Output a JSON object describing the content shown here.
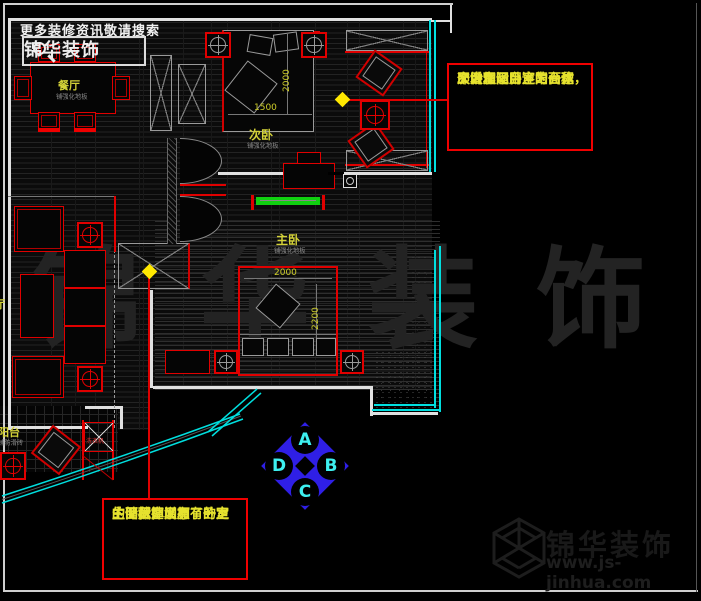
{
  "header": {
    "tagline": "更多装修资讯敬请搜索",
    "brand": "锦华装饰",
    "icon": "magnifier-icon"
  },
  "plan": {
    "rooms": [
      {
        "name": "餐厅",
        "floor_note": "铺强化地板"
      },
      {
        "name": "次卧",
        "floor_note": "铺强化地板"
      },
      {
        "name": "主卧",
        "floor_note": "铺强化地板"
      },
      {
        "name": "阳台",
        "floor_note": "铺防滑砖"
      },
      {
        "name": "厅",
        "floor_note": ""
      }
    ],
    "dimensions": {
      "second_bed_width": "1500",
      "second_bed_length": "2000",
      "master_bed_width": "2000",
      "master_bed_length": "2200"
    },
    "equipment_label": "洗衣机"
  },
  "annotations": [
    {
      "lines": [
        "次卧和阳台连为一体，",
        "即增加了卧室的面积",
        "又合理运用了阳台这",
        "个大空间"
      ]
    },
    {
      "lines": [
        "主卧拆掉了原有的卫",
        "生间，即增加了卧室",
        "的面积，又有了一定",
        "的储藏空间。"
      ]
    }
  ],
  "compass": {
    "top": "A",
    "right": "B",
    "bottom": "C",
    "left": "D"
  },
  "watermark": "锦华装饰",
  "footer": {
    "brand": "锦华装饰",
    "website": "www.js-jinhua.com"
  },
  "colors": {
    "wall": "#e0e0e0",
    "accent_red": "#e00000",
    "window_cyan": "#00dede",
    "label_yellow": "#d4d238",
    "note_yellow": "#e6e22e",
    "compass_blue": "#2f1fe6",
    "compass_letter": "#3df0f0",
    "tv_green": "#10d010",
    "highlight_yellow": "#ffe800"
  }
}
